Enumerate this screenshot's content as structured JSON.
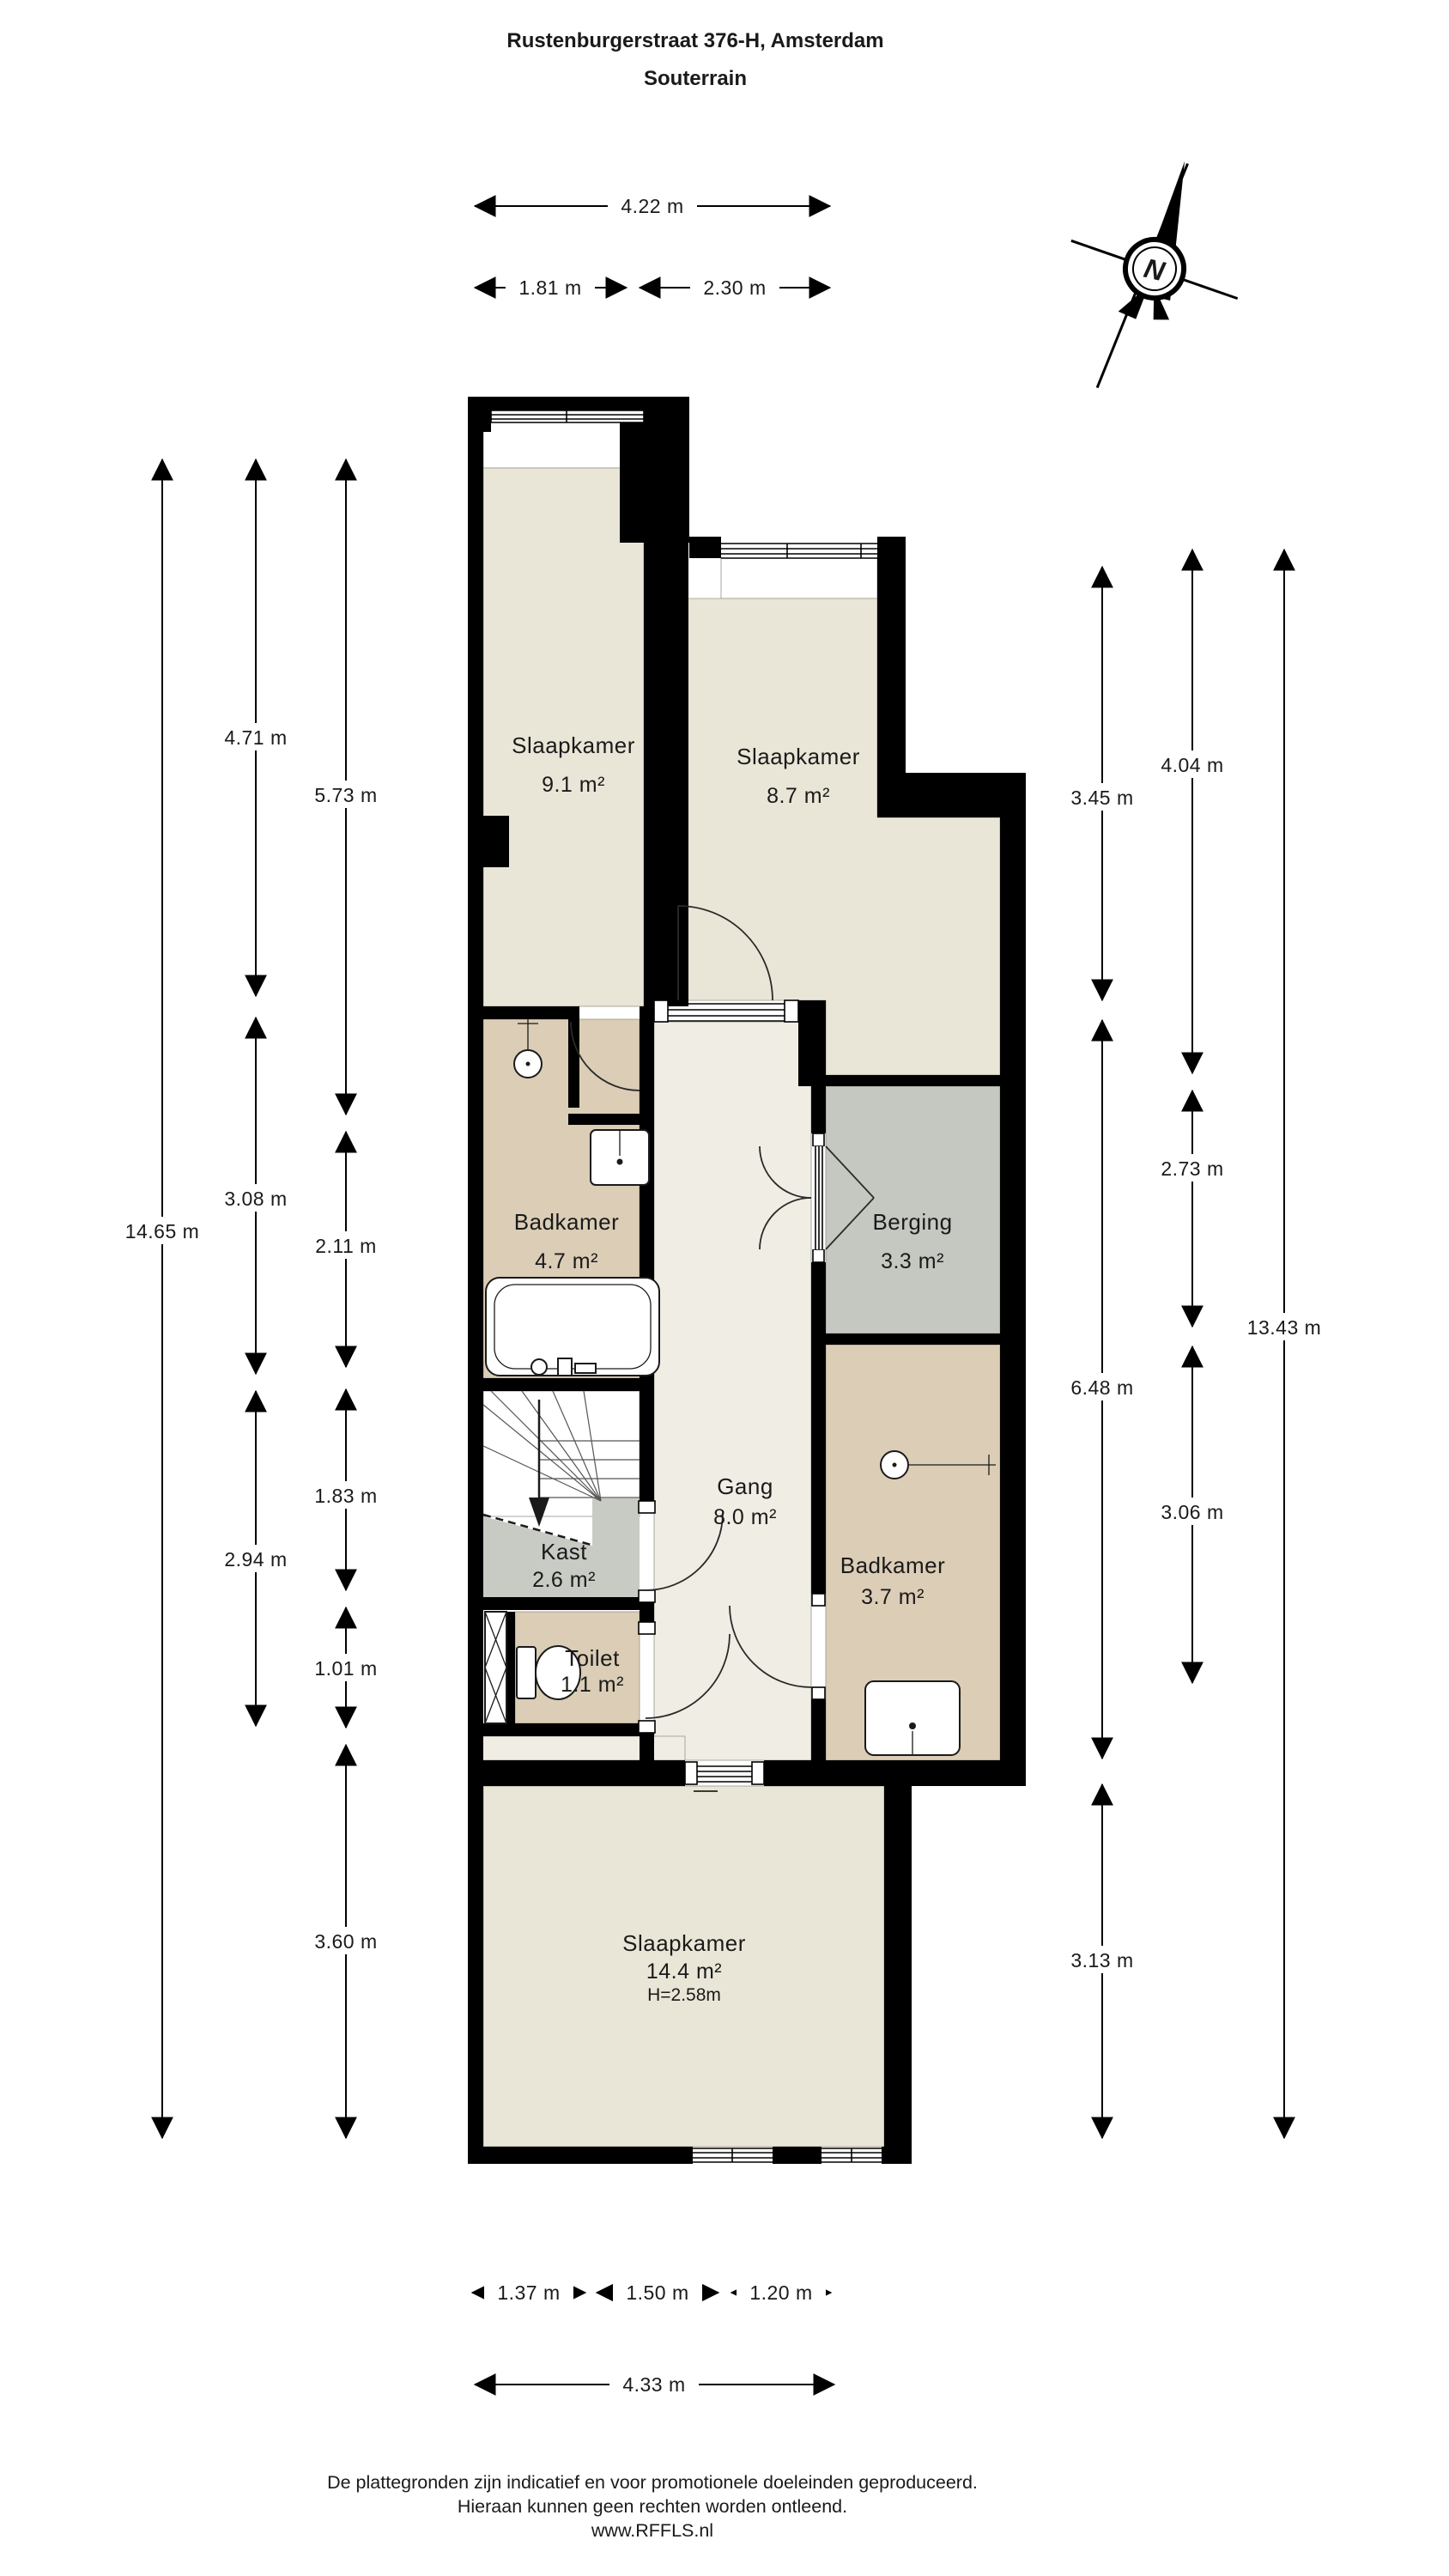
{
  "title": {
    "address": "Rustenburgerstraat 376-H, Amsterdam",
    "floor": "Souterrain"
  },
  "compass": {
    "north_label": "N"
  },
  "rooms": {
    "slaapkamer_links": {
      "name": "Slaapkamer",
      "area": "9.1 m²"
    },
    "slaapkamer_rechts": {
      "name": "Slaapkamer",
      "area": "8.7 m²"
    },
    "badkamer_boven": {
      "name": "Badkamer",
      "area": "4.7 m²"
    },
    "berging": {
      "name": "Berging",
      "area": "3.3 m²"
    },
    "gang": {
      "name": "Gang",
      "area": "8.0 m²"
    },
    "kast": {
      "name": "Kast",
      "area": "2.6 m²"
    },
    "toilet": {
      "name": "Toilet",
      "area": "1.1 m²"
    },
    "badkamer_onder": {
      "name": "Badkamer",
      "area": "3.7 m²"
    },
    "slaapkamer_onder": {
      "name": "Slaapkamer",
      "area": "14.4 m²",
      "ceiling_height": "H=2.58m"
    }
  },
  "dimensions": {
    "top": {
      "total": "4.22 m",
      "segments": [
        "1.81 m",
        "2.30 m"
      ]
    },
    "bottom": {
      "segments": [
        "1.37 m",
        "1.50 m",
        "1.20 m"
      ],
      "total": "4.33 m"
    },
    "left": {
      "overall": "14.65 m",
      "col_a": [
        "4.71 m",
        "3.08 m",
        "2.94 m"
      ],
      "col_b": [
        "5.73 m",
        "2.11 m",
        "1.83 m",
        "1.01 m",
        "3.60 m"
      ]
    },
    "right": {
      "overall": "13.43 m",
      "col_a": [
        "3.45 m",
        "6.48 m",
        "3.13 m"
      ],
      "col_b": [
        "4.04 m",
        "2.73 m",
        "3.06 m"
      ]
    }
  },
  "footer": {
    "line1": "De plattegronden zijn indicatief en voor promotionele doeleinden geproduceerd.",
    "line2": "Hieraan kunnen geen rechten worden ontleend.",
    "line3": "www.RFFLS.nl"
  },
  "colors": {
    "wall": "#000000",
    "room_cream": "#EAE6D7",
    "room_tan": "#DBCDB6",
    "room_gray": "#C5C7C1",
    "room_light": "#EFEDE4",
    "kast_gray": "#C8CAC4",
    "line": "#1A1A1A",
    "background": "#FFFFFF"
  }
}
